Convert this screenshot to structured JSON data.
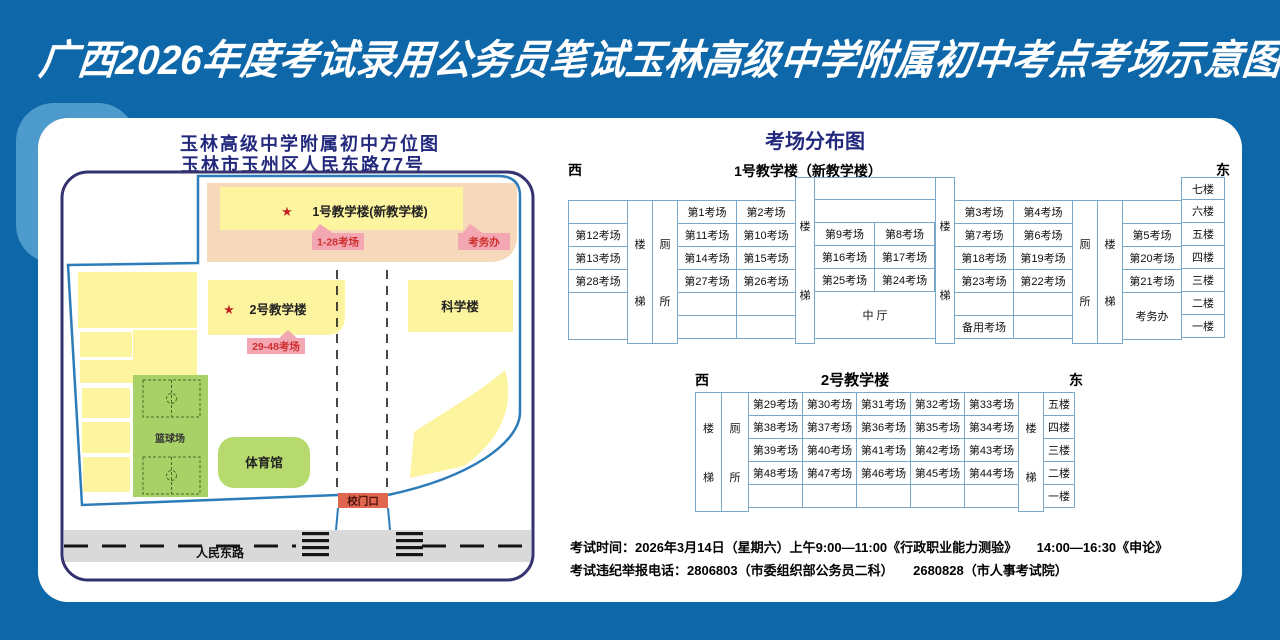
{
  "colors": {
    "background": "#0e67a8",
    "corner_accent": "#4d9acd",
    "heading_navy": "#232a7d",
    "table_border": "#7aa8c8",
    "building_yellow": "#fcf49e",
    "band_salmon": "#f6d8ba",
    "badge_pink": "#f2a7b2",
    "badge_text_red": "#cf2f2f",
    "green_court": "#a8d168",
    "green_gym": "#b7da6e",
    "gate_red": "#e0664f",
    "road_gray": "#d9d9d9",
    "boundary_blue": "#2b7cb8"
  },
  "banner": {
    "title": "广西2026年度考试录用公务员笔试玉林高级中学附属初中考点考场示意图"
  },
  "map": {
    "title_line1": "玉林高级中学附属初中方位图",
    "title_line2": "玉林市玉州区人民东路77号",
    "star": "★",
    "building1_label": "1号教学楼(新教学楼)",
    "building1_badge": "1-28考场",
    "office_badge": "考务办",
    "building2_label": "2号教学楼",
    "building2_badge": "29-48考场",
    "science_label": "科学楼",
    "basketball_label": "篮球场",
    "gym_label": "体育馆",
    "gate_label": "校门口",
    "road_label": "人民东路"
  },
  "distribution": {
    "title": "考场分布图",
    "west": "西",
    "east": "东",
    "stair_top": "楼",
    "stair_bottom": "梯",
    "toilet_top": "厕",
    "toilet_bottom": "所",
    "t1": {
      "title": "1号教学楼（新教学楼）",
      "colA": [
        "",
        "第12考场",
        "第13考场",
        "第28考场",
        ""
      ],
      "colB1": [
        "第1考场",
        "第11考场",
        "第14考场",
        "第27考场",
        "",
        ""
      ],
      "colB2": [
        "第2考场",
        "第10考场",
        "第15考场",
        "第26考场",
        "",
        ""
      ],
      "colC1": [
        "第9考场",
        "第16考场",
        "第25考场"
      ],
      "colC2": [
        "第8考场",
        "第17考场",
        "第24考场"
      ],
      "hall": "中 厅",
      "colD1": [
        "第3考场",
        "第7考场",
        "第18考场",
        "第23考场",
        "",
        "备用考场"
      ],
      "colD2": [
        "第4考场",
        "第6考场",
        "第19考场",
        "第22考场",
        "",
        ""
      ],
      "colF": [
        "",
        "第5考场",
        "第20考场",
        "第21考场"
      ],
      "office": "考务办",
      "floors": [
        "七楼",
        "六楼",
        "五楼",
        "四楼",
        "三楼",
        "二楼",
        "一楼"
      ]
    },
    "t2": {
      "title": "2号教学楼",
      "rows": [
        [
          "第29考场",
          "第30考场",
          "第31考场",
          "第32考场",
          "第33考场"
        ],
        [
          "第38考场",
          "第37考场",
          "第36考场",
          "第35考场",
          "第34考场"
        ],
        [
          "第39考场",
          "第40考场",
          "第41考场",
          "第42考场",
          "第43考场"
        ],
        [
          "第48考场",
          "第47考场",
          "第46考场",
          "第45考场",
          "第44考场"
        ],
        [
          "",
          "",
          "",
          "",
          ""
        ]
      ],
      "floors": [
        "五楼",
        "四楼",
        "三楼",
        "二楼",
        "一楼"
      ]
    }
  },
  "footer": {
    "line1": "考试时间：2026年3月14日（星期六）上午9:00—11:00《行政职业能力测验》　　14:00—16:30《申论》",
    "line2": "考试违纪举报电话：2806803（市委组织部公务员二科）　　2680828（市人事考试院）"
  }
}
